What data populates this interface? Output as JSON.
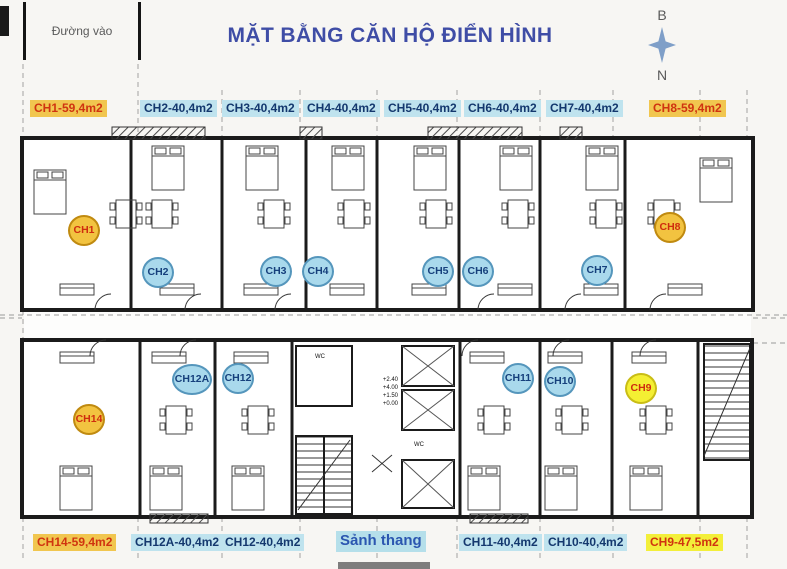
{
  "header": {
    "entrance_label": "Đường vào",
    "title": "MẶT BẰNG CĂN HỘ ĐIỂN HÌNH",
    "compass": {
      "north_label": "B",
      "south_label": "N"
    }
  },
  "colors": {
    "title": "#3F4DA6",
    "label_yellow_bg": "#F1C64F",
    "label_bright_yellow_bg": "#F3EF3A",
    "label_cyan_bg": "#BFE3EE",
    "label_red_text": "#D03410",
    "label_navy_text": "#14386E",
    "lobby_text": "#2B56B0",
    "badge_yellow": "#F2C340",
    "badge_bright_yellow": "#F4EF33",
    "badge_cyan": "#A9D9EC",
    "compass_star": "#7F9FC8",
    "wall": "#1B1B1B"
  },
  "unit_labels_top": [
    {
      "text": "CH1-59,4m2",
      "type": "yellow",
      "x": 30
    },
    {
      "text": "CH2-40,4m2",
      "type": "cyan",
      "x": 140
    },
    {
      "text": "CH3-40,4m2",
      "type": "cyan",
      "x": 222
    },
    {
      "text": "CH4-40,4m2",
      "type": "cyan",
      "x": 303
    },
    {
      "text": "CH5-40,4m2",
      "type": "cyan",
      "x": 384
    },
    {
      "text": "CH6-40,4m2",
      "type": "cyan",
      "x": 464
    },
    {
      "text": "CH7-40,4m2",
      "type": "cyan",
      "x": 546
    },
    {
      "text": "CH8-59,4m2",
      "type": "yellow",
      "x": 649
    }
  ],
  "unit_labels_bottom": [
    {
      "text": "CH14-59,4m2",
      "type": "yellow",
      "x": 33
    },
    {
      "text": "CH12A-40,4m2",
      "type": "cyan",
      "x": 131
    },
    {
      "text": "CH12-40,4m2",
      "type": "cyan",
      "x": 221
    },
    {
      "text": "Sảnh thang",
      "type": "lobby",
      "x": 336
    },
    {
      "text": "CH11-40,4m2",
      "type": "cyan",
      "x": 459
    },
    {
      "text": "CH10-40,4m2",
      "type": "cyan",
      "x": 544
    },
    {
      "text": "CH9-47,5m2",
      "type": "bright",
      "x": 646
    }
  ],
  "badges": [
    {
      "id": "CH1",
      "type": "yellow",
      "cx": 84,
      "cy": 230
    },
    {
      "id": "CH2",
      "type": "cyan",
      "cx": 158,
      "cy": 272
    },
    {
      "id": "CH3",
      "type": "cyan",
      "cx": 276,
      "cy": 271
    },
    {
      "id": "CH4",
      "type": "cyan",
      "cx": 318,
      "cy": 271
    },
    {
      "id": "CH5",
      "type": "cyan",
      "cx": 438,
      "cy": 271
    },
    {
      "id": "CH6",
      "type": "cyan",
      "cx": 478,
      "cy": 271
    },
    {
      "id": "CH7",
      "type": "cyan",
      "cx": 597,
      "cy": 270
    },
    {
      "id": "CH8",
      "type": "yellow",
      "cx": 670,
      "cy": 227
    },
    {
      "id": "CH14",
      "type": "yellow",
      "cx": 89,
      "cy": 419
    },
    {
      "id": "CH12A",
      "type": "cyan",
      "cx": 192,
      "cy": 379,
      "w": 40
    },
    {
      "id": "CH12",
      "type": "cyan",
      "cx": 238,
      "cy": 378
    },
    {
      "id": "CH11",
      "type": "cyan",
      "cx": 518,
      "cy": 378
    },
    {
      "id": "CH10",
      "type": "cyan",
      "cx": 560,
      "cy": 381
    },
    {
      "id": "CH9",
      "type": "bright",
      "cx": 641,
      "cy": 388
    }
  ],
  "plan": {
    "levels": [
      "+2.40",
      "+4.00",
      "+1.50",
      "+0.00"
    ],
    "wc_label": "WC"
  }
}
